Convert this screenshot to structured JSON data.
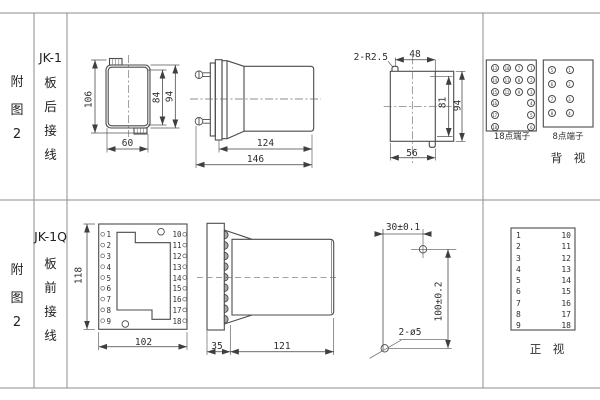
{
  "colors": {
    "grid_line": "#8e8e8e",
    "drawing_line": "#4b4b4b",
    "text": "#2e2e2e"
  },
  "rows": {
    "top": {
      "fig": [
        "附",
        "图",
        "2"
      ],
      "model": "JK-1",
      "wiring": [
        "板",
        "后",
        "接",
        "线"
      ]
    },
    "bottom": {
      "fig": [
        "附",
        "图",
        "2"
      ],
      "model": "JK-1Q",
      "wiring": [
        "板",
        "前",
        "接",
        "线"
      ]
    }
  },
  "top": {
    "front": {
      "d106": "106",
      "d84": "84",
      "d94": "94",
      "d60": "60"
    },
    "side": {
      "d124": "124",
      "d146": "146"
    },
    "cutout": {
      "slot": "2-R2.5",
      "d48": "48",
      "d81": "81",
      "d94": "94",
      "d56": "56"
    },
    "t18": {
      "label": "18点端子",
      "rows": [
        [
          "13",
          "10",
          "7",
          "1"
        ],
        [
          "14",
          "11",
          "8",
          "2"
        ],
        [
          "15",
          "12",
          "9",
          "3"
        ]
      ],
      "left": [
        "16",
        "17",
        "18"
      ],
      "right": [
        "4",
        "5",
        "6"
      ]
    },
    "t8": {
      "label": "8点端子",
      "rows": [
        [
          "5",
          "1"
        ],
        [
          "6",
          "2"
        ],
        [
          "7",
          "3"
        ],
        [
          "8",
          "4"
        ]
      ]
    },
    "view": "背　视"
  },
  "bottom": {
    "front": {
      "d118": "118",
      "d102": "102",
      "left": [
        "1",
        "2",
        "3",
        "4",
        "5",
        "6",
        "7",
        "8",
        "9"
      ],
      "right": [
        "10",
        "11",
        "12",
        "13",
        "14",
        "15",
        "16",
        "17",
        "18"
      ]
    },
    "side": {
      "d35": "35",
      "d121": "121"
    },
    "drill": {
      "d30": "30±0.1",
      "d100": "100±0.2",
      "holes": "2-ø5"
    },
    "map": {
      "left": [
        "1",
        "2",
        "3",
        "4",
        "5",
        "6",
        "7",
        "8",
        "9"
      ],
      "right": [
        "10",
        "11",
        "12",
        "13",
        "14",
        "15",
        "16",
        "17",
        "18"
      ]
    },
    "view": "正　视"
  }
}
